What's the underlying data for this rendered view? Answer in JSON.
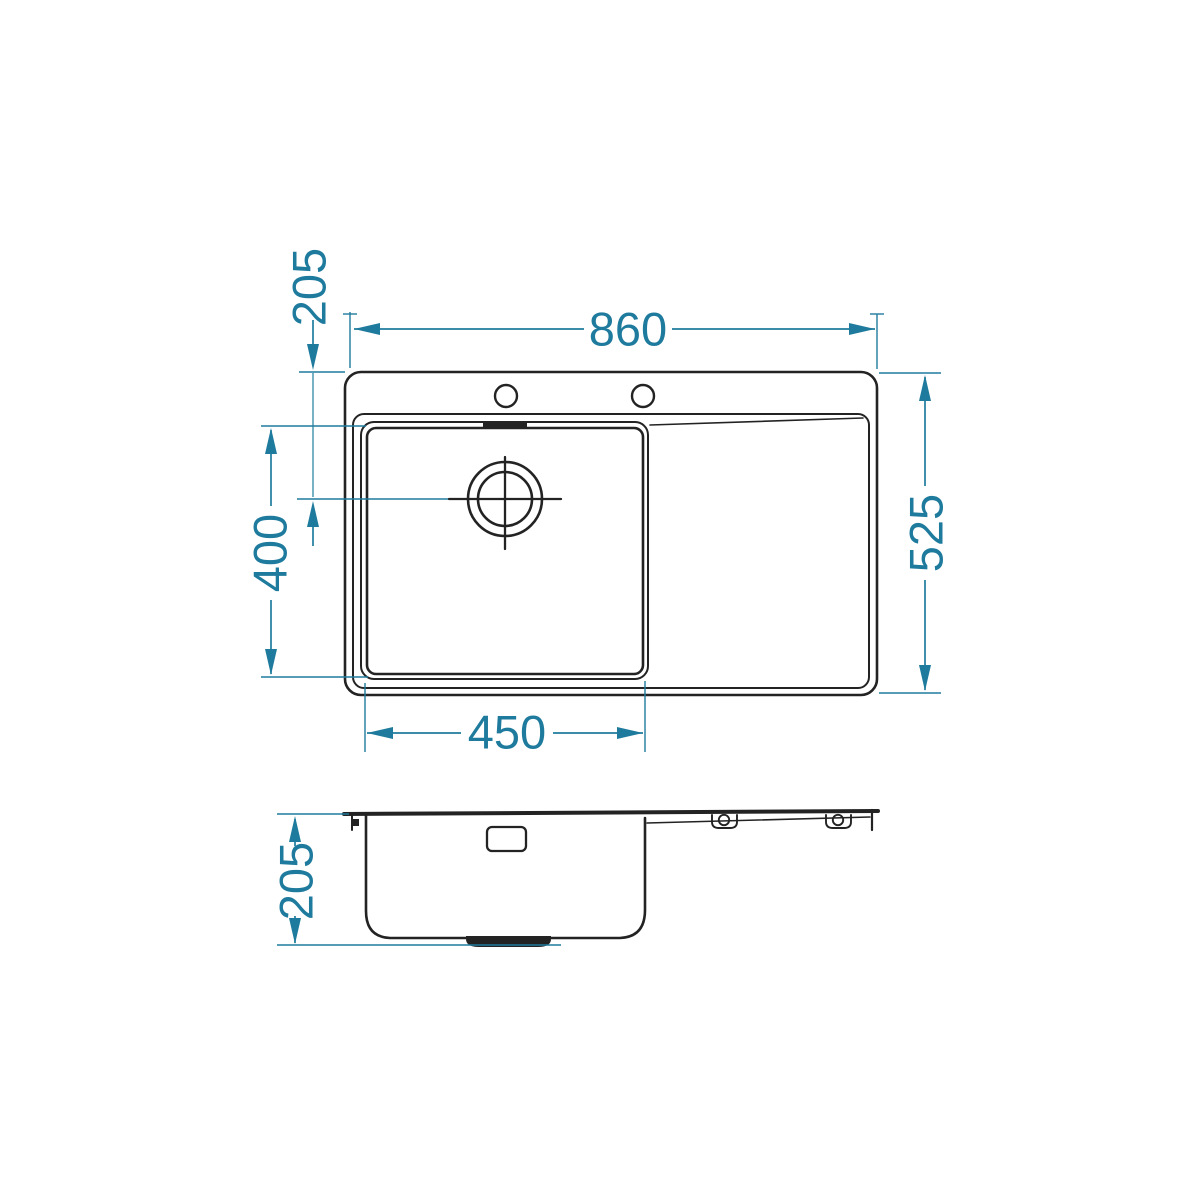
{
  "drawing": {
    "subject": "Kitchen sink technical drawing - top view and side section view",
    "colors": {
      "outline": "#232323",
      "dimension": "#1f7b9d",
      "background": "#ffffff"
    },
    "top_view": {
      "dimensions": {
        "overall_width": "860",
        "overall_depth": "525",
        "bowl_width": "450",
        "bowl_depth": "400",
        "drain_offset": "205"
      }
    },
    "side_view": {
      "dimensions": {
        "bowl_height": "205"
      }
    }
  }
}
